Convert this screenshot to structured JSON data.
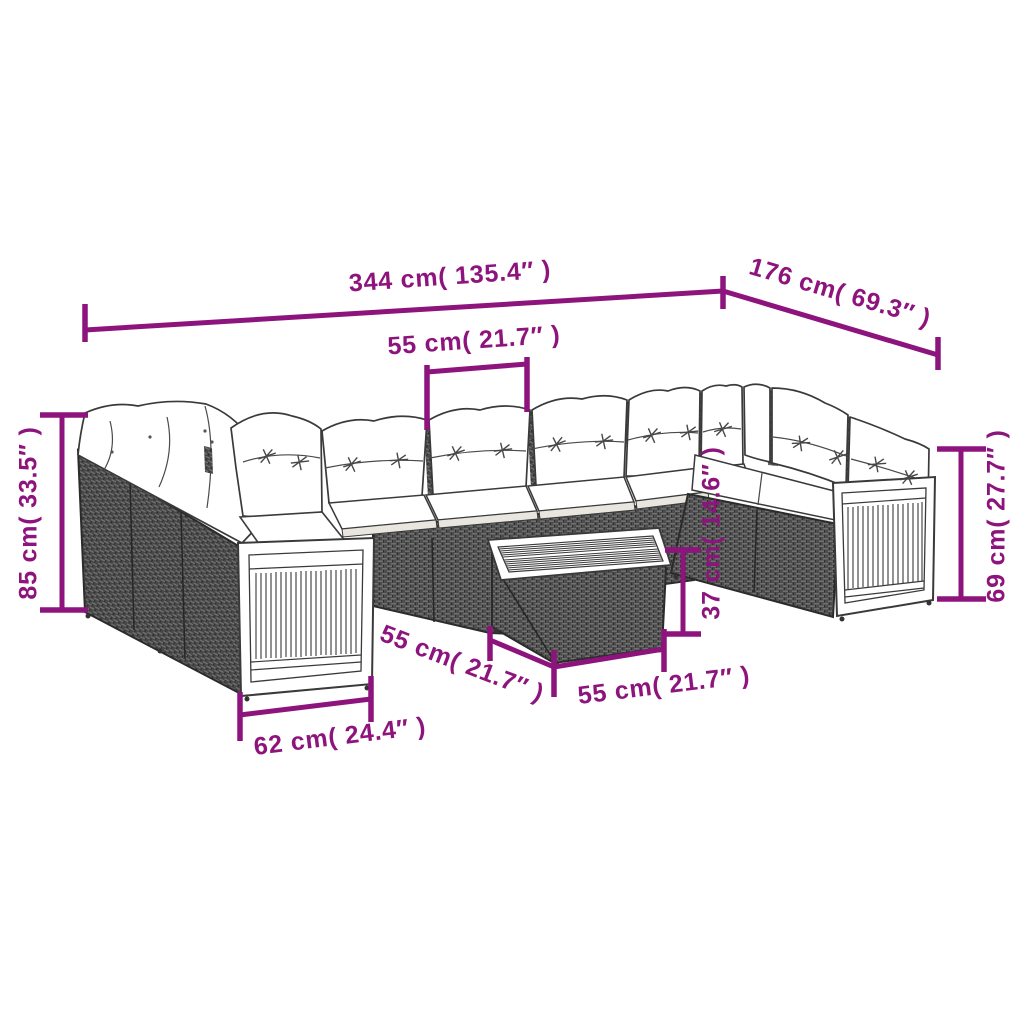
{
  "colors": {
    "accent": "#8E147D",
    "line_art": "#3A3A3A",
    "rattan": "#4D4D4D",
    "cushion": "#FFFFFF"
  },
  "measurements": {
    "overall_width": "344 cm( 135.4″ )",
    "overall_depth": "176 cm( 69.3″ )",
    "seat_width": "55 cm( 21.7″ )",
    "overall_height": "85 cm( 33.5″ )",
    "back_height": "69 cm( 27.7″ )",
    "table_height": "37 cm( 14.6″ )",
    "table_depth": "55 cm( 21.7″ )",
    "table_width": "55 cm( 21.7″ )",
    "end_module_width": "62 cm( 24.4″ )"
  }
}
